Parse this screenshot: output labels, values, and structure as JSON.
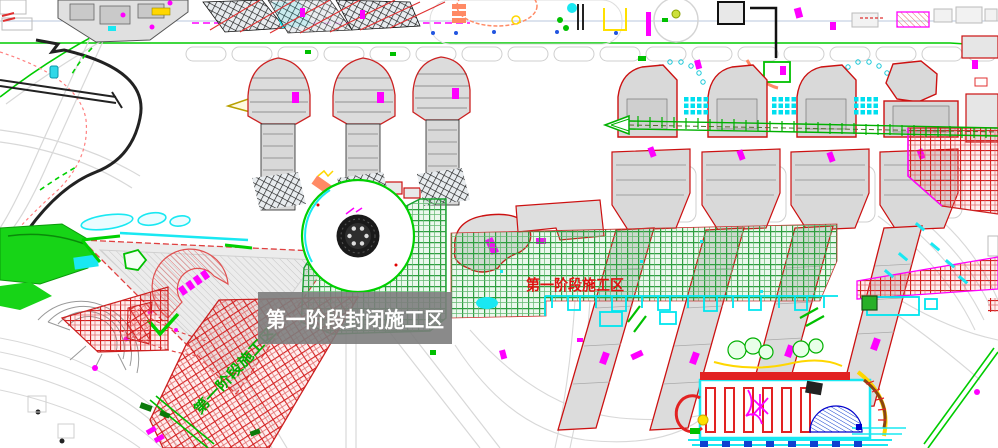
{
  "annotations": {
    "closed_zone_label": "第一阶段封闭施工区",
    "phase1_zone_label_red": "第一阶段施工区",
    "phase1_zone_label_diagonal": "第一阶段施工区"
  },
  "colors": {
    "label_bg": "#7d7d7d",
    "label_text": "#ffffff",
    "phase_text_red": "#e01010",
    "phase_text_green": "#00b000",
    "hatch_red": "#d42222",
    "hatch_green": "#2e9e40",
    "road_green": "#00cc00",
    "cad_cyan": "#19e8f2",
    "cad_magenta": "#ff00ff",
    "building_outline_red": "#cc1111"
  }
}
